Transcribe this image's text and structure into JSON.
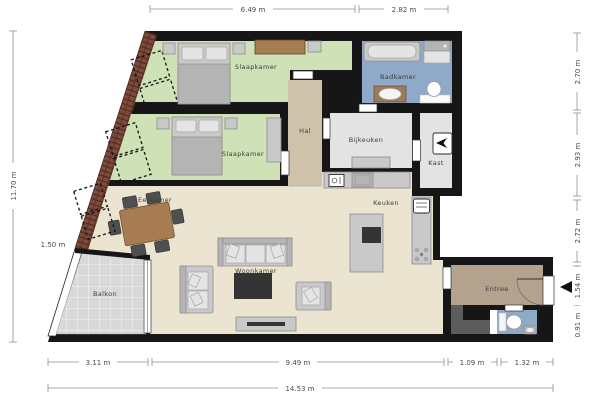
{
  "rooms": {
    "slaapkamer1": {
      "label": "Slaapkamer"
    },
    "slaapkamer2": {
      "label": "Slaapkamer"
    },
    "badkamer": {
      "label": "Badkamer"
    },
    "hal": {
      "label": "Hal"
    },
    "bijkeuken": {
      "label": "Bijkeuken"
    },
    "kast": {
      "label": "Kast"
    },
    "keuken": {
      "label": "Keuken"
    },
    "eetkamer": {
      "label": "Eetkamer"
    },
    "woonkamer": {
      "label": "Woonkamer"
    },
    "balkon": {
      "label": "Balkon"
    },
    "entree": {
      "label": "Entree"
    }
  },
  "dims": {
    "top1": "6.49 m",
    "top2": "2.82 m",
    "left1": "11.70 m",
    "left2": "1.50 m",
    "right1": "2.70 m",
    "right2": "2.93 m",
    "right3": "2.72 m",
    "right4": "1.54 m",
    "right5": "0.91 m",
    "bottom1": "3.11 m",
    "bottom2": "9.49 m",
    "bottom3": "1.09 m",
    "bottom4": "1.32 m",
    "total": "14.53 m"
  },
  "icons": {
    "entrance_arrow": "left-pointing-triangle",
    "boiler": "cv-unit",
    "burner": "gas-burner",
    "dishwasher": "glass-fork",
    "fridge": "refrigerator"
  },
  "colors": {
    "wall": "#161616",
    "bedroom": "#cfe1b6",
    "bathroom": "#8fa9c9",
    "hall": "#cec2ab",
    "utility": "#e3e3e3",
    "living": "#ebe4d1",
    "entry": "#b3a28e",
    "balcony": "#dadada",
    "brick": "#7d4b3b",
    "wood": "#a87c52",
    "shaft": "#5c5c5c"
  }
}
